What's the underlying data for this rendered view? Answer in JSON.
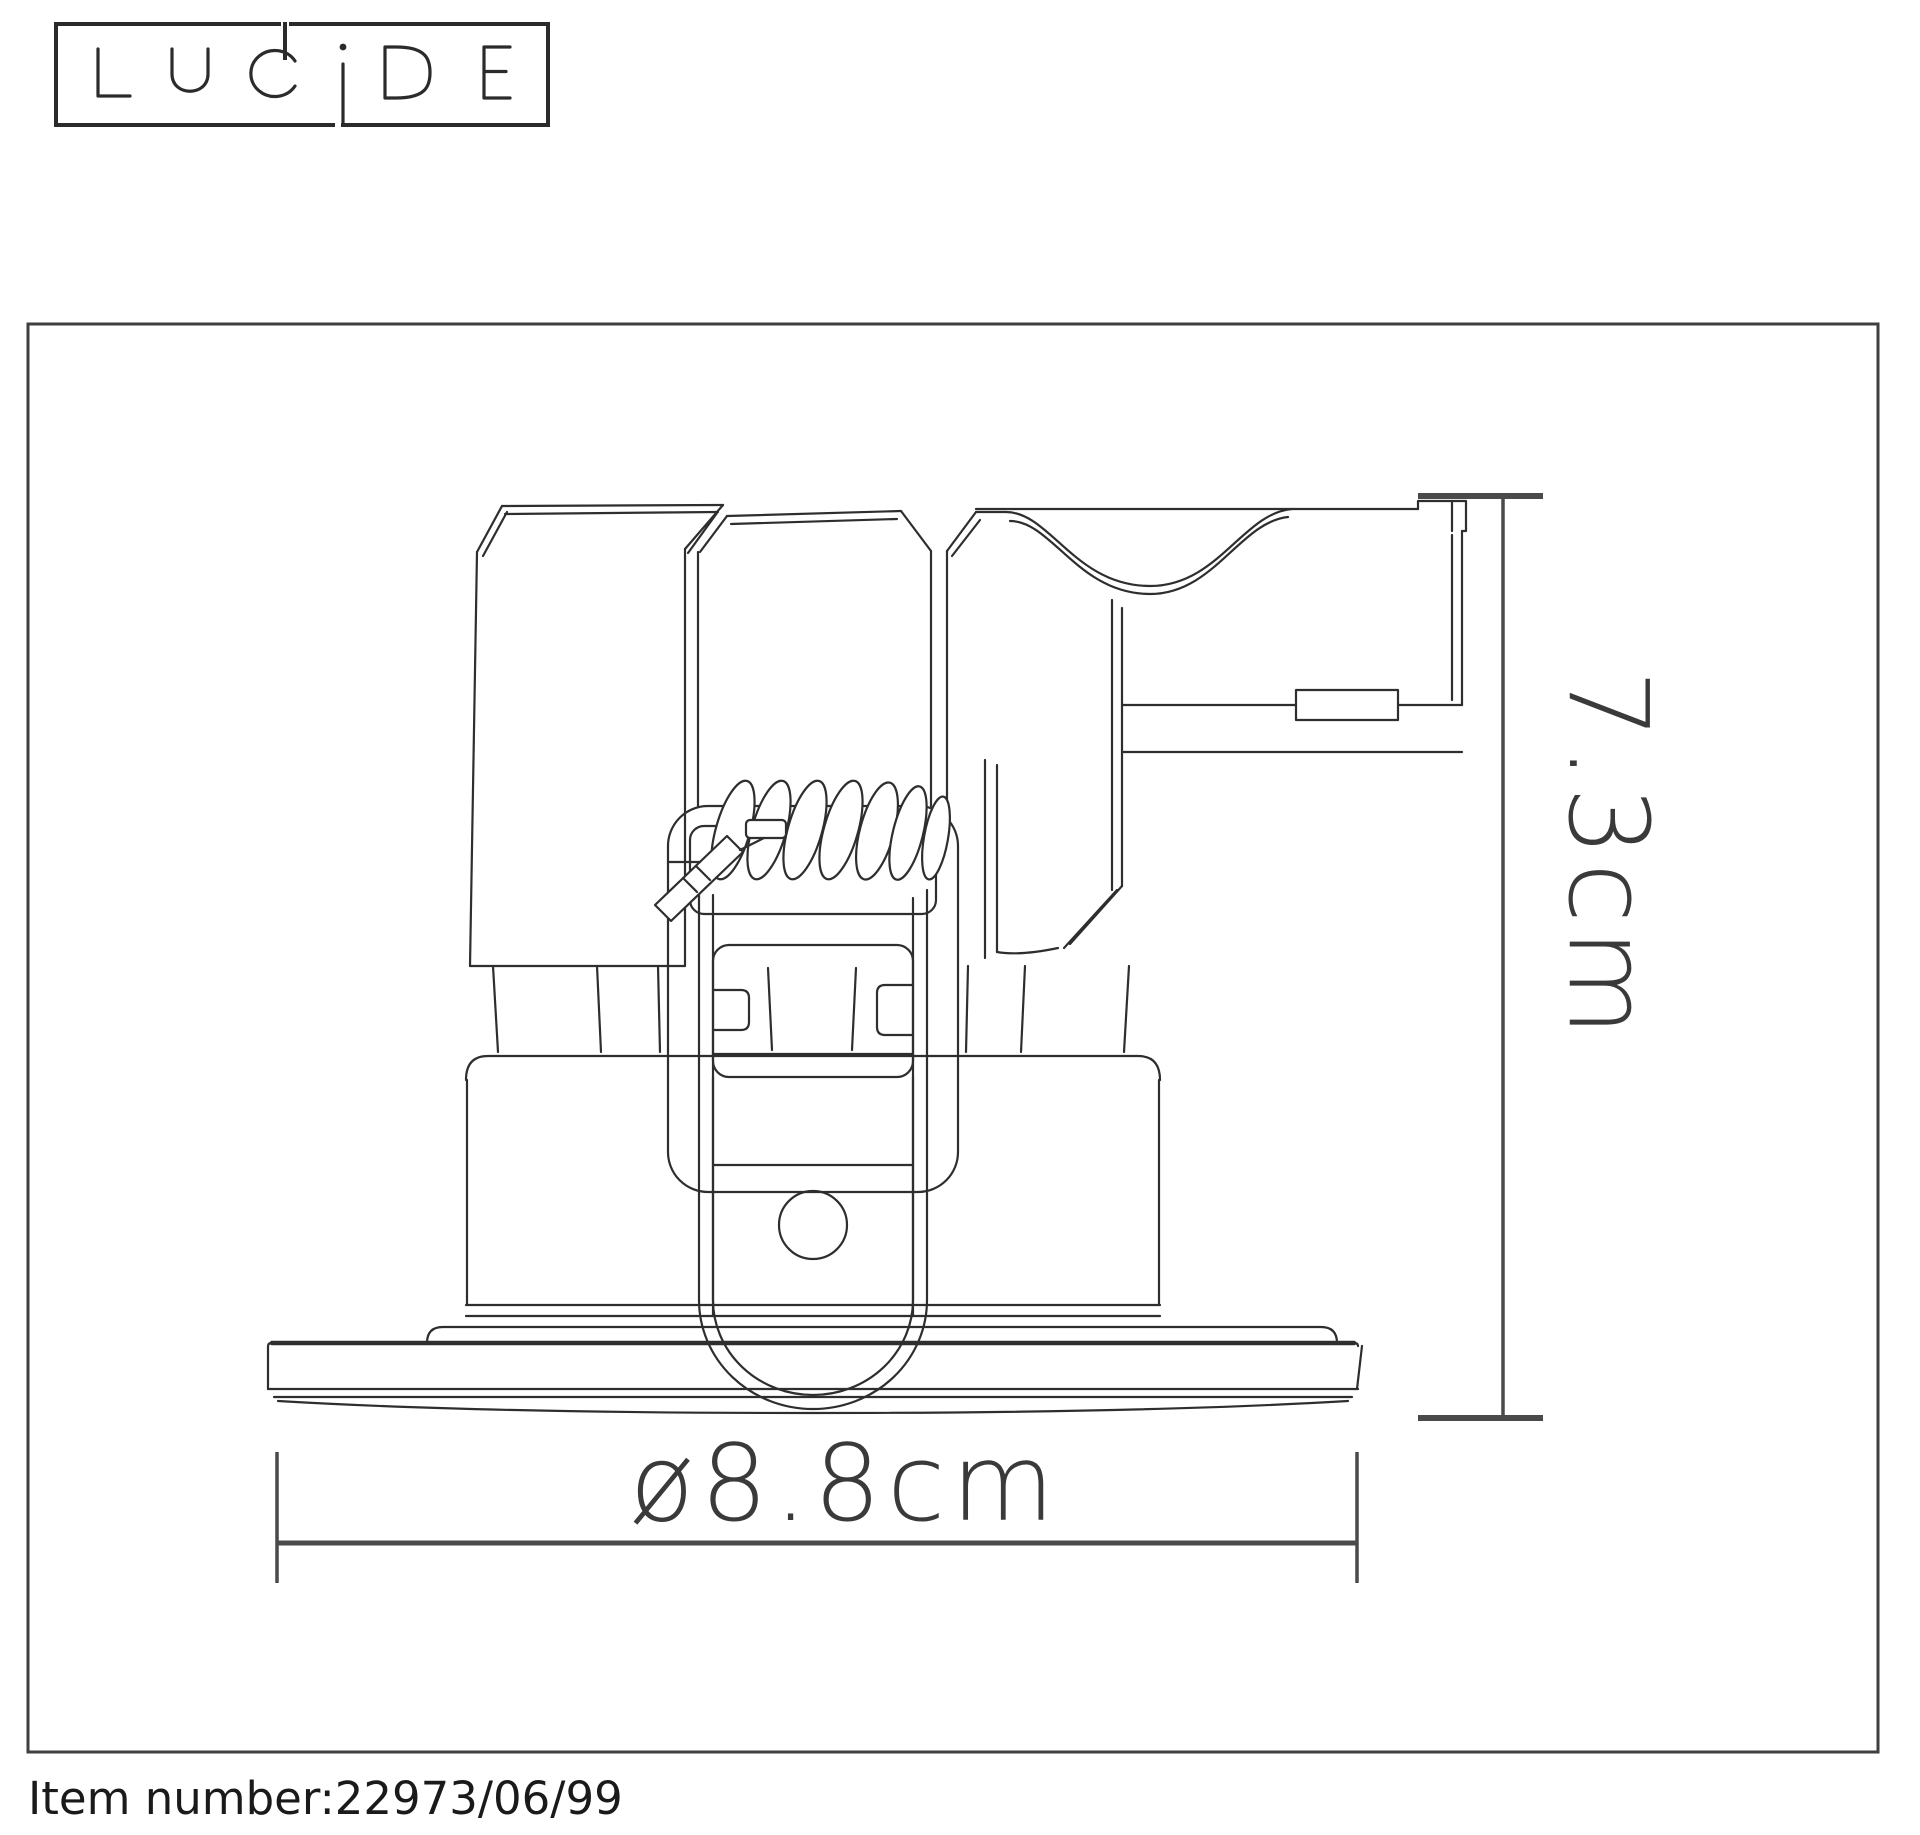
{
  "logo": {
    "text": "LUCIDE"
  },
  "drawing": {
    "height_label": "7.3cm",
    "diameter_label": "ø8.8cm"
  },
  "footer": {
    "item_label": "Item number:22973/06/99"
  },
  "colors": {
    "bg": "#ffffff",
    "line": "#2e2e2e",
    "dim": "#4a4a4a",
    "text": "#3a3a3a"
  }
}
